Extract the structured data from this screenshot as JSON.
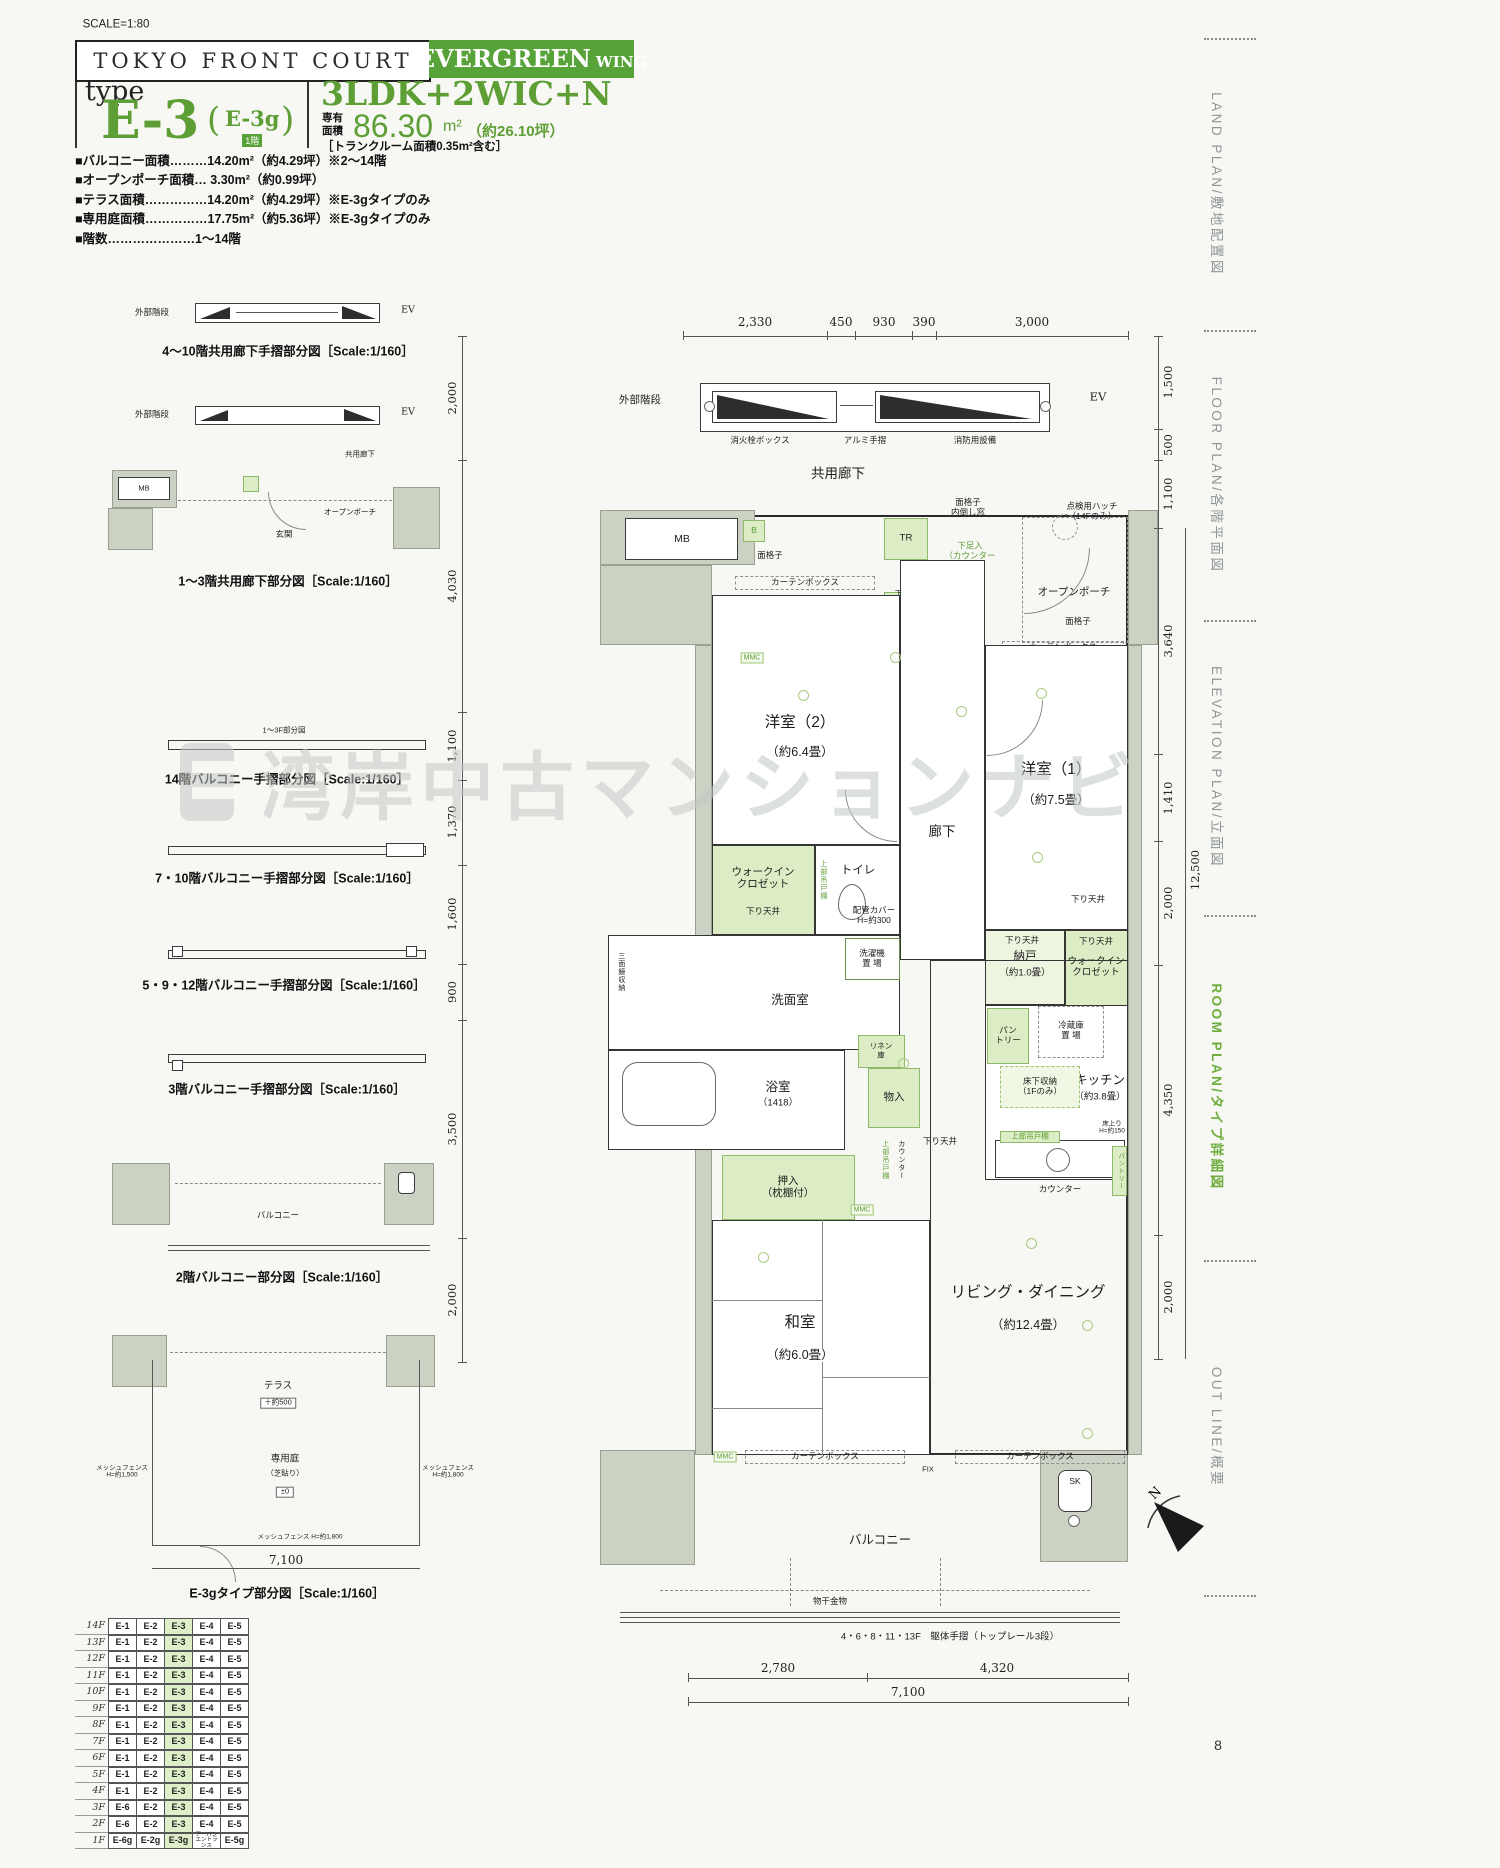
{
  "page": {
    "scale_note": "SCALE=1:80",
    "number": "8"
  },
  "watermark": "湾岸中古マンションナビ",
  "header": {
    "project": "TOKYO FRONT COURT",
    "wing_name": "EVERGREEN",
    "wing_suffix": "WING",
    "type_label": "type",
    "type_name": "E-3",
    "paren_open": "(",
    "type_alt": "E-3g",
    "type_alt_floor": "1階",
    "paren_close": ")",
    "layout": "3LDK+2WIC+N",
    "area_label_top": "専有",
    "area_label_bottom": "面積",
    "area_value": "86.30",
    "area_unit": "m²",
    "area_tsubo": "（約26.10坪）",
    "area_note": "［トランクルーム面積0.35m²含む］"
  },
  "specs": [
    "■バルコニー面積………14.20m²（約4.29坪）※2〜14階",
    "■オープンポーチ面積… 3.30m²（約0.99坪）",
    "■テラス面積……………14.20m²（約4.29坪）※E-3gタイプのみ",
    "■専用庭面積……………17.75m²（約5.36坪）※E-3gタイプのみ",
    "■階数…………………1〜14階"
  ],
  "diagrams": [
    {
      "caption": "4〜10階共用廊下手摺部分図［Scale:1/160］",
      "labels": {
        "stairs": "外部階段",
        "ev": "EV"
      }
    },
    {
      "caption": "1〜3階共用廊下部分図［Scale:1/160］",
      "labels": {
        "stairs": "外部階段",
        "ev": "EV",
        "corridor": "共用廊下",
        "mb": "MB",
        "genkan": "玄関",
        "porch": "オープンポーチ"
      }
    },
    {
      "caption": "14階バルコニー手摺部分図［Scale:1/160］",
      "note": "1〜3F部分図"
    },
    {
      "caption": "7・10階バルコニー手摺部分図［Scale:1/160］"
    },
    {
      "caption": "5・9・12階バルコニー手摺部分図［Scale:1/160］"
    },
    {
      "caption": "3階バルコニー手摺部分図［Scale:1/160］"
    },
    {
      "caption": "2階バルコニー部分図［Scale:1/160］",
      "labels": {
        "balcony": "バルコニー"
      }
    },
    {
      "caption": "E-3gタイプ部分図［Scale:1/160］",
      "labels": {
        "terrace": "テラス",
        "terrace_level": "＋約500",
        "garden": "専用庭",
        "garden_note": "（芝貼り）",
        "garden_level": "±0",
        "fence_left": "メッシュフェンス\nH=約1,500",
        "fence_right": "メッシュフェンス\nH=約1,800",
        "fence_bottom": "メッシュフェンス H=約1,800",
        "dim": "7,100"
      }
    }
  ],
  "plan": {
    "dims_top": [
      "2,330",
      "450",
      "930",
      "390",
      "3,000"
    ],
    "dims_bottom": [
      "2,780",
      "4,320",
      "7,100"
    ],
    "dims_left": [
      "2,000",
      "4,030",
      "1,100",
      "1,370",
      "1,600",
      "900",
      "3,500",
      "2,000"
    ],
    "dims_right": [
      "1,500",
      "500",
      "1,100",
      "3,640",
      "1,410",
      "2,000",
      "4,350",
      "2,000"
    ],
    "dim_right_total": "12,500",
    "labels": {
      "stairs": "外部階段",
      "ev": "EV",
      "hydrant": "消火栓ボックス",
      "handrail": "アルミ手摺",
      "fire": "消防用設備",
      "corridor": "共用廊下",
      "mb": "MB",
      "b": "B",
      "tr": "TR",
      "lattice": "面格子",
      "lattice_tilt": "面格子\n内倒し窓",
      "shoe_counter": "下足入\n（カウンター\nタイプ）",
      "hatch": "点検用ハッチ\n（14Fのみ）",
      "genkan": "玄関",
      "porch": "オープンポーチ",
      "curtain": "カーテンボックス",
      "shoe_tall": "下足入（トールタイプ）",
      "mmc": "MMC",
      "r2": "洋室（2）",
      "r2_size": "（約6.4畳）",
      "r1": "洋室（1）",
      "r1_size": "（約7.5畳）",
      "hall": "廊下",
      "wic": "ウォークイン\nクロゼット",
      "sagari": "下り天井",
      "toilet": "トイレ",
      "pipe_cover": "配管カバー\nH=約300",
      "ps": "PS",
      "washer": "洗濯機\n置 場",
      "nando": "納戸",
      "nando_size": "（約1.0畳）",
      "senmen": "洗面室",
      "mirror": "三面鏡収納",
      "linen": "リネン\n庫",
      "bath": "浴室",
      "bath_size": "（1418）",
      "monoire": "物入",
      "pantry": "パン\nトリー",
      "pantry2": "パントリー",
      "fridge": "冷蔵庫\n置 場",
      "kitchen": "キッチン",
      "kitchen_size": "（約3.8畳）",
      "floor_storage": "床下収納\n（1Fのみ）",
      "floor_up": "床上り\nH=約150",
      "cupboard": "上部吊戸棚",
      "counter": "カウンター",
      "oshiire": "押入\n（枕棚付）",
      "washitsu": "和室",
      "washitsu_size": "（約6.0畳）",
      "living": "リビング・ダイニング",
      "living_size": "（約12.4畳）",
      "fix": "FIX",
      "sk": "SK",
      "balcony": "バルコニー",
      "monohoshi": "物干金物",
      "rail_note": "4・6・8・11・13F　躯体手摺（トップレール3段）"
    }
  },
  "sidebar": {
    "tabs": [
      {
        "en": "LAND PLAN",
        "ja": "敷地配置図",
        "active": false
      },
      {
        "en": "FLOOR PLAN",
        "ja": "各階平面図",
        "active": false
      },
      {
        "en": "ELEVATION PLAN",
        "ja": "立面図",
        "active": false
      },
      {
        "en": "ROOM PLAN",
        "ja": "タイプ詳細図",
        "active": true
      },
      {
        "en": "OUT LINE",
        "ja": "概要",
        "active": false
      }
    ]
  },
  "compass": {
    "label": "N"
  },
  "floor_table": {
    "highlight_col": 2,
    "rows": [
      {
        "floor": "14F",
        "cells": [
          "E-1",
          "E-2",
          "E-3",
          "E-4",
          "E-5"
        ]
      },
      {
        "floor": "13F",
        "cells": [
          "E-1",
          "E-2",
          "E-3",
          "E-4",
          "E-5"
        ]
      },
      {
        "floor": "12F",
        "cells": [
          "E-1",
          "E-2",
          "E-3",
          "E-4",
          "E-5"
        ]
      },
      {
        "floor": "11F",
        "cells": [
          "E-1",
          "E-2",
          "E-3",
          "E-4",
          "E-5"
        ]
      },
      {
        "floor": "10F",
        "cells": [
          "E-1",
          "E-2",
          "E-3",
          "E-4",
          "E-5"
        ]
      },
      {
        "floor": "9F",
        "cells": [
          "E-1",
          "E-2",
          "E-3",
          "E-4",
          "E-5"
        ]
      },
      {
        "floor": "8F",
        "cells": [
          "E-1",
          "E-2",
          "E-3",
          "E-4",
          "E-5"
        ]
      },
      {
        "floor": "7F",
        "cells": [
          "E-1",
          "E-2",
          "E-3",
          "E-4",
          "E-5"
        ]
      },
      {
        "floor": "6F",
        "cells": [
          "E-1",
          "E-2",
          "E-3",
          "E-4",
          "E-5"
        ]
      },
      {
        "floor": "5F",
        "cells": [
          "E-1",
          "E-2",
          "E-3",
          "E-4",
          "E-5"
        ]
      },
      {
        "floor": "4F",
        "cells": [
          "E-1",
          "E-2",
          "E-3",
          "E-4",
          "E-5"
        ]
      },
      {
        "floor": "3F",
        "cells": [
          "E-6",
          "E-2",
          "E-3",
          "E-4",
          "E-5"
        ]
      },
      {
        "floor": "2F",
        "cells": [
          "E-6",
          "E-2",
          "E-3",
          "E-4",
          "E-5"
        ]
      },
      {
        "floor": "1F",
        "cells": [
          "E-6g",
          "E-2g",
          "E-3g",
          "アーバン\nエントランス",
          "E-5g"
        ]
      }
    ]
  }
}
